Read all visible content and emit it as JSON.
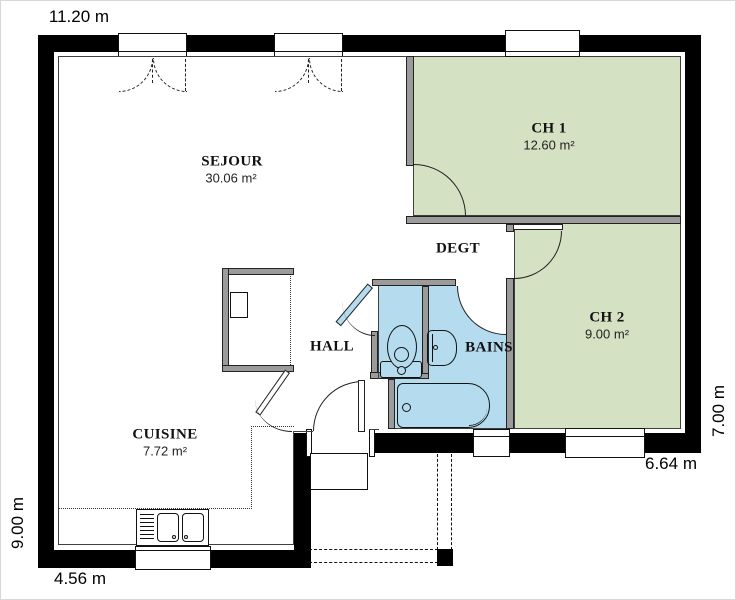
{
  "dimensions": {
    "top": "11.20 m",
    "left": "9.00 m",
    "right": "7.00 m",
    "bottom_left": "4.56 m",
    "bottom_right": "6.64 m"
  },
  "rooms": {
    "sejour": {
      "name": "SEJOUR",
      "area": "30.06 m²"
    },
    "cuisine": {
      "name": "CUISINE",
      "area": "7.72 m²"
    },
    "hall": {
      "name": "HALL"
    },
    "degt": {
      "name": "DEGT"
    },
    "bains": {
      "name": "BAINS"
    },
    "ch1": {
      "name": "CH 1",
      "area": "12.60 m²"
    },
    "ch2": {
      "name": "CH 2",
      "area": "9.00 m²"
    }
  },
  "fixtures": [
    "toilet",
    "washbasin",
    "bathtub",
    "double-kitchen-sink-with-drainer",
    "water-heater-closet",
    "entrance-porch-post"
  ],
  "colors": {
    "bedroom_fill": "#d5e1c3",
    "bath_fill": "#b5dcee",
    "exterior_wall": "#000000",
    "partition_wall": "#9b9b9b",
    "background": "#ffffff"
  }
}
